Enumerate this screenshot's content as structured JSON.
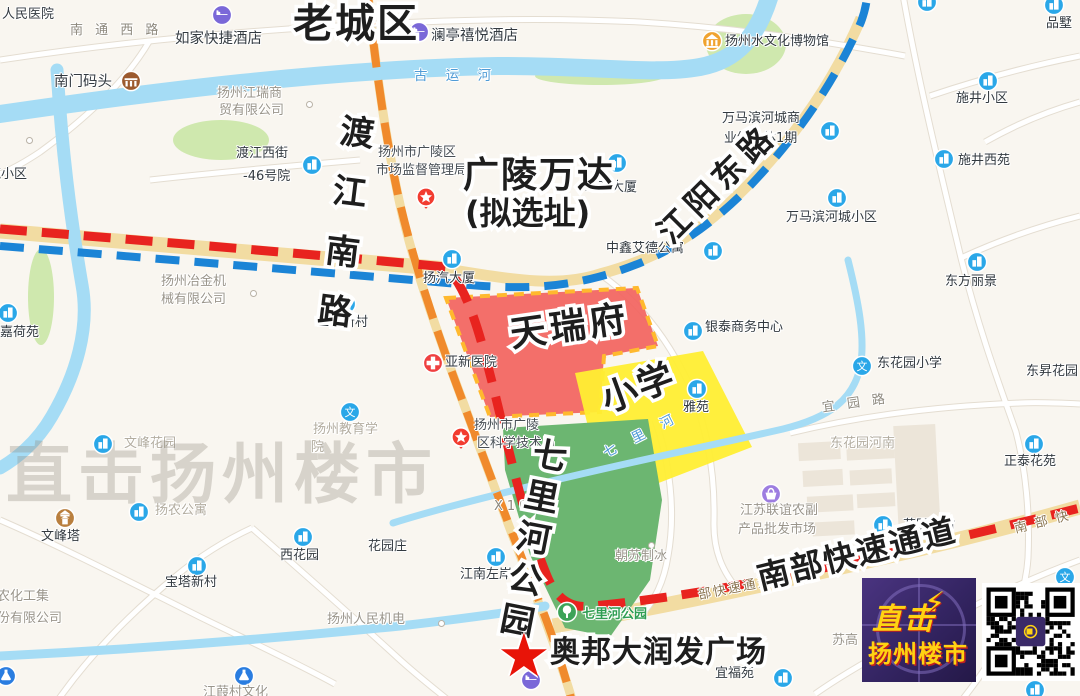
{
  "map": {
    "watermark": "直击扬州楼市",
    "annotations": [
      {
        "t": "老城区",
        "x": 293,
        "y": 4,
        "s": 40,
        "r": 0,
        "v": 0,
        "sp": 2
      },
      {
        "t": "渡江南路",
        "x": 339,
        "y": 112,
        "s": 34,
        "r": 7,
        "v": 1,
        "sp": 26
      },
      {
        "t": "江阳东路",
        "x": 652,
        "y": 226,
        "s": 32,
        "r": -45,
        "v": 0,
        "sp": 6
      },
      {
        "t": "广陵万达",
        "x": 463,
        "y": 158,
        "s": 36,
        "r": 0,
        "v": 0,
        "sp": 2
      },
      {
        "t": "(拟选址)",
        "x": 465,
        "y": 197,
        "s": 32,
        "r": 0,
        "v": 0,
        "sp": 0
      },
      {
        "t": "天瑞府",
        "x": 508,
        "y": 318,
        "s": 36,
        "r": -8,
        "v": 0,
        "sp": 4
      },
      {
        "t": "小学",
        "x": 597,
        "y": 385,
        "s": 36,
        "r": -20,
        "v": 0,
        "sp": 2
      },
      {
        "t": "七里河公园",
        "x": 533,
        "y": 434,
        "s": 34,
        "r": 11,
        "v": 1,
        "sp": 8
      },
      {
        "t": "南部快速通道",
        "x": 754,
        "y": 563,
        "s": 32,
        "r": -14,
        "v": 0,
        "sp": 2
      },
      {
        "t": "奥邦大润发广场",
        "x": 550,
        "y": 638,
        "s": 30,
        "r": 0,
        "v": 0,
        "sp": 1
      }
    ],
    "star_marker": {
      "glyph": "★",
      "x": 497,
      "y": 626
    },
    "labels": [
      {
        "t": "人民医院",
        "x": 2,
        "y": 8,
        "cls": ""
      },
      {
        "t": "南 通 西 路",
        "x": 70,
        "y": 24,
        "cls": "road"
      },
      {
        "t": "如家快捷酒店",
        "x": 175,
        "y": 31,
        "cls": "poi-lg"
      },
      {
        "t": "澜亭禧悦酒店",
        "x": 431,
        "y": 28,
        "cls": "poi-lg"
      },
      {
        "t": "古 运 河",
        "x": 414,
        "y": 69,
        "cls": "water"
      },
      {
        "t": "扬州水文化博物馆",
        "x": 725,
        "y": 35,
        "cls": ""
      },
      {
        "t": "品墅",
        "x": 1046,
        "y": 17,
        "cls": ""
      },
      {
        "t": "施井小区",
        "x": 956,
        "y": 92,
        "cls": ""
      },
      {
        "t": "施井西苑",
        "x": 958,
        "y": 154,
        "cls": ""
      },
      {
        "t": "万马滨河城商",
        "x": 722,
        "y": 112,
        "cls": ""
      },
      {
        "t": "业综合体1期",
        "x": 724,
        "y": 132,
        "cls": ""
      },
      {
        "t": "万马滨河城小区",
        "x": 786,
        "y": 211,
        "cls": ""
      },
      {
        "t": "东方丽景",
        "x": 945,
        "y": 275,
        "cls": ""
      },
      {
        "t": "渡江西街",
        "x": 236,
        "y": 147,
        "cls": ""
      },
      {
        "t": "-46号院",
        "x": 243,
        "y": 170,
        "cls": ""
      },
      {
        "t": "扬州江瑞商",
        "x": 217,
        "y": 87,
        "cls": "company"
      },
      {
        "t": "贸有限公司",
        "x": 219,
        "y": 104,
        "cls": "company"
      },
      {
        "t": "南门码头",
        "x": 54,
        "y": 74,
        "cls": "poi-lg"
      },
      {
        "t": "嘉荷苑",
        "x": 0,
        "y": 326,
        "cls": ""
      },
      {
        "t": "扬州冶金机",
        "x": 161,
        "y": 275,
        "cls": "company"
      },
      {
        "t": "械有限公司",
        "x": 161,
        "y": 293,
        "cls": "company"
      },
      {
        "t": "工人新村",
        "x": 316,
        "y": 316,
        "cls": ""
      },
      {
        "t": "扬汽大厦",
        "x": 423,
        "y": 272,
        "cls": ""
      },
      {
        "t": "亚新医院",
        "x": 445,
        "y": 356,
        "cls": ""
      },
      {
        "t": "琼花大厦",
        "x": 585,
        "y": 181,
        "cls": ""
      },
      {
        "t": "中鑫艾德公寓",
        "x": 606,
        "y": 242,
        "cls": ""
      },
      {
        "t": "银泰商务中心",
        "x": 705,
        "y": 321,
        "cls": ""
      },
      {
        "t": "雅苑",
        "x": 683,
        "y": 401,
        "cls": ""
      },
      {
        "t": "东花园小学",
        "x": 877,
        "y": 357,
        "cls": ""
      },
      {
        "t": "宜 园 路",
        "x": 822,
        "y": 397,
        "cls": "road",
        "r": -8
      },
      {
        "t": "东花园河南",
        "x": 830,
        "y": 437,
        "cls": "faded"
      },
      {
        "t": "正泰花苑",
        "x": 1004,
        "y": 455,
        "cls": ""
      },
      {
        "t": "东昇花园",
        "x": 1026,
        "y": 365,
        "cls": ""
      },
      {
        "t": "江苏联谊农副",
        "x": 740,
        "y": 504,
        "cls": "company"
      },
      {
        "t": "产品批发市场",
        "x": 738,
        "y": 523,
        "cls": "company"
      },
      {
        "t": "朝苏制冰",
        "x": 615,
        "y": 550,
        "cls": "company"
      },
      {
        "t": "X105",
        "x": 494,
        "y": 500,
        "cls": "road"
      },
      {
        "t": "七 里 河",
        "x": 600,
        "y": 428,
        "cls": "water",
        "r": -27
      },
      {
        "t": "扬州市广陵区",
        "x": 378,
        "y": 146,
        "cls": "dark"
      },
      {
        "t": "市场监督管理局",
        "x": 376,
        "y": 164,
        "cls": "dark"
      },
      {
        "t": "扬州市广陵",
        "x": 474,
        "y": 419,
        "cls": "dark"
      },
      {
        "t": "区科学技术局",
        "x": 477,
        "y": 437,
        "cls": "dark"
      },
      {
        "t": "扬州教育学",
        "x": 313,
        "y": 423,
        "cls": "faded"
      },
      {
        "t": "院",
        "x": 311,
        "y": 441,
        "cls": "faded"
      },
      {
        "t": "花园庄",
        "x": 368,
        "y": 540,
        "cls": ""
      },
      {
        "t": "西花园",
        "x": 280,
        "y": 549,
        "cls": ""
      },
      {
        "t": "宝塔新村",
        "x": 165,
        "y": 576,
        "cls": ""
      },
      {
        "t": "文峰塔",
        "x": 41,
        "y": 530,
        "cls": ""
      },
      {
        "t": "文峰花园",
        "x": 124,
        "y": 437,
        "cls": "faded"
      },
      {
        "t": "扬农公寓",
        "x": 155,
        "y": 504,
        "cls": "faded"
      },
      {
        "t": "江南左岸",
        "x": 460,
        "y": 568,
        "cls": ""
      },
      {
        "t": "七里河公园",
        "x": 582,
        "y": 608,
        "cls": "green"
      },
      {
        "t": "扬州人民机电",
        "x": 327,
        "y": 613,
        "cls": "company"
      },
      {
        "t": "宜福苑",
        "x": 715,
        "y": 667,
        "cls": ""
      },
      {
        "t": "苏高",
        "x": 832,
        "y": 634,
        "cls": "company"
      },
      {
        "t": "花园新村",
        "x": 903,
        "y": 519,
        "cls": ""
      },
      {
        "t": "扬农化工集",
        "x": -16,
        "y": 590,
        "cls": "company"
      },
      {
        "t": "股份有限公司",
        "x": -16,
        "y": 612,
        "cls": "company"
      },
      {
        "t": "江葭村文化",
        "x": 203,
        "y": 686,
        "cls": "company"
      },
      {
        "t": "苑小区",
        "x": -12,
        "y": 168,
        "cls": ""
      },
      {
        "t": "南 部 快",
        "x": 1014,
        "y": 516,
        "cls": "roadname",
        "r": -14
      },
      {
        "t": "部快速通道",
        "x": 698,
        "y": 582,
        "cls": "roadname",
        "r": -11
      }
    ],
    "icons": [
      {
        "type": "hotel",
        "x": 222,
        "y": 15
      },
      {
        "type": "hotel",
        "x": 419,
        "y": 32
      },
      {
        "type": "hotel",
        "x": 531,
        "y": 680
      },
      {
        "type": "museum",
        "x": 712,
        "y": 41
      },
      {
        "type": "pier",
        "x": 131,
        "y": 81
      },
      {
        "type": "pagoda",
        "x": 65,
        "y": 518
      },
      {
        "type": "hospital",
        "x": 433,
        "y": 363
      },
      {
        "type": "market",
        "x": 771,
        "y": 494
      },
      {
        "type": "flask",
        "x": 6,
        "y": 676
      },
      {
        "type": "flask",
        "x": 244,
        "y": 676
      },
      {
        "type": "park",
        "x": 567,
        "y": 612
      },
      {
        "type": "star-badge",
        "x": 426,
        "y": 194
      },
      {
        "type": "star-badge",
        "x": 461,
        "y": 434
      },
      {
        "type": "school",
        "x": 862,
        "y": 366
      },
      {
        "type": "school",
        "x": 350,
        "y": 412
      },
      {
        "type": "school",
        "x": 1065,
        "y": 577
      },
      {
        "type": "bldg",
        "x": 1054,
        "y": 5
      },
      {
        "type": "bldg",
        "x": 927,
        "y": 2
      },
      {
        "type": "bldg",
        "x": 988,
        "y": 81
      },
      {
        "type": "bldg",
        "x": 944,
        "y": 159
      },
      {
        "type": "bldg",
        "x": 830,
        "y": 131
      },
      {
        "type": "bldg",
        "x": 837,
        "y": 198
      },
      {
        "type": "bldg",
        "x": 977,
        "y": 262
      },
      {
        "type": "bldg",
        "x": 312,
        "y": 165
      },
      {
        "type": "bldg",
        "x": 8,
        "y": 313
      },
      {
        "type": "bldg",
        "x": 346,
        "y": 304
      },
      {
        "type": "bldg",
        "x": 452,
        "y": 259
      },
      {
        "type": "bldg",
        "x": 617,
        "y": 163
      },
      {
        "type": "bldg",
        "x": 713,
        "y": 251
      },
      {
        "type": "bldg",
        "x": 693,
        "y": 331
      },
      {
        "type": "bldg",
        "x": 697,
        "y": 389
      },
      {
        "type": "bldg",
        "x": 1034,
        "y": 444
      },
      {
        "type": "bldg",
        "x": 303,
        "y": 537
      },
      {
        "type": "bldg",
        "x": 197,
        "y": 566
      },
      {
        "type": "bldg",
        "x": 103,
        "y": 444
      },
      {
        "type": "bldg",
        "x": 139,
        "y": 512
      },
      {
        "type": "bldg",
        "x": 496,
        "y": 557
      },
      {
        "type": "bldg",
        "x": 783,
        "y": 678
      },
      {
        "type": "bldg",
        "x": 883,
        "y": 525
      },
      {
        "type": "bldg",
        "x": 1035,
        "y": 690
      }
    ],
    "dots": [
      {
        "x": 306,
        "y": 101
      },
      {
        "x": 250,
        "y": 290
      },
      {
        "x": 438,
        "y": 620
      },
      {
        "x": 648,
        "y": 542
      },
      {
        "x": 26,
        "y": 137
      }
    ]
  },
  "branding": {
    "logo_line1": "直击",
    "logo_bolt": "⚡",
    "logo_line2": "扬州楼市"
  }
}
